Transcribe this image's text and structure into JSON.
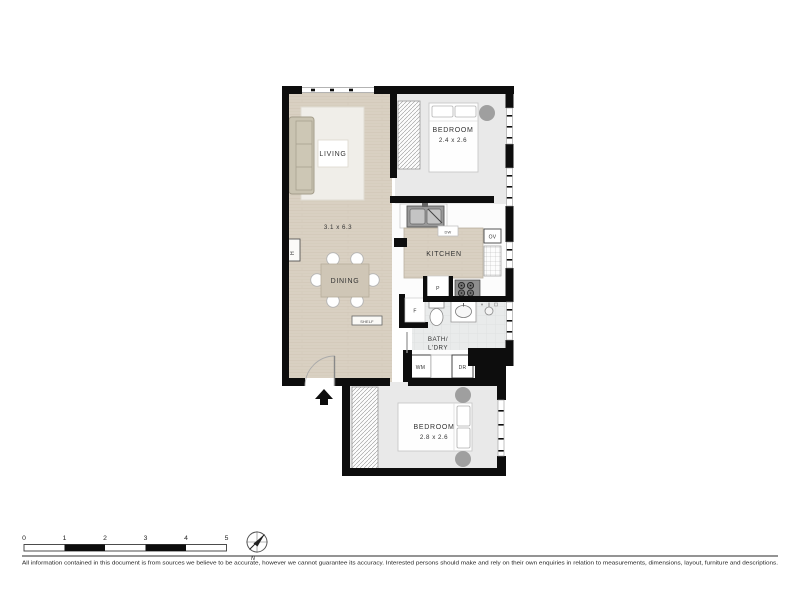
{
  "plan": {
    "living": {
      "label": "LIVING",
      "dimensions": "3.1 x 6.3"
    },
    "dining": {
      "label": "DINING"
    },
    "kitchen": {
      "label": "KITCHEN"
    },
    "bedroom_top": {
      "label": "BEDROOM",
      "dimensions": "2.4 x 2.6"
    },
    "bedroom_bottom": {
      "label": "BEDROOM",
      "dimensions": "2.8 x 2.6"
    },
    "bath_laundry": {
      "line1": "BATH/",
      "line2": "L'DRY"
    },
    "fixtures": {
      "dishwasher": "DW",
      "oven": "OV",
      "pantry": "P",
      "fridge": "F",
      "washing_machine": "WM",
      "dryer": "DR",
      "shelf": "SHELF",
      "hot_water": "H"
    }
  },
  "scale_bar": {
    "labels": [
      "0",
      "1",
      "2",
      "3",
      "4",
      "5"
    ]
  },
  "compass": {
    "label": "N"
  },
  "footer": {
    "disclaimer": "All information contained in this document is from sources we believe to be accurate, however we cannot guarantee its accuracy. Interested persons should make and rely on their own enquiries in relation to measurements, dimensions, layout, furniture and descriptions."
  },
  "colors": {
    "wall": "#0d0d0d",
    "floor_wood": "#d9d0c2",
    "floor_carpet": "#e9e9e9",
    "floor_tile": "#e9ebeb",
    "furniture_beige": "#c9c3b1",
    "accent_gray": "#9f9f9f"
  }
}
